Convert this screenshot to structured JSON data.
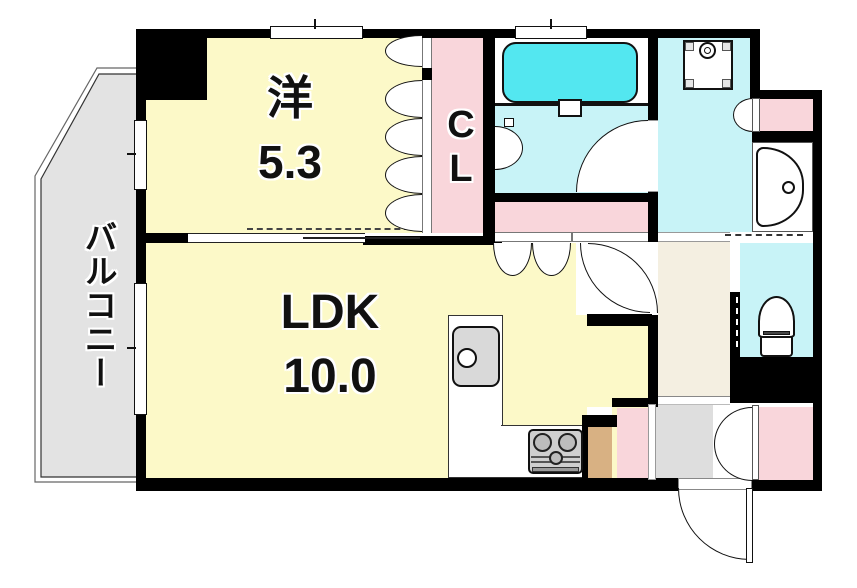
{
  "plan": {
    "type": "apartment-floor-plan",
    "rooms": {
      "western": {
        "label": "洋",
        "size": "5.3"
      },
      "ldk": {
        "label": "LDK",
        "size": "10.0"
      },
      "closet": {
        "label": "CL"
      },
      "balcony": {
        "label": "バルコニー"
      }
    },
    "fixtures": [
      "bathtub",
      "washing-machine-pan",
      "washbasin",
      "toilet",
      "kitchen-sink",
      "gas-stove"
    ],
    "colors": {
      "room_yellow": "#FCF9C8",
      "closet_pink": "#F9D6DB",
      "sanitary_cyan": "#C8F3F7",
      "bathtub_cyan": "#53E7F0",
      "balcony_gray": "#E3E3E3",
      "entrance_gray": "#DEDEDE",
      "hallway_beige": "#F4EFE1",
      "counter_tan": "#D8B183",
      "wall_black": "#000000"
    }
  }
}
